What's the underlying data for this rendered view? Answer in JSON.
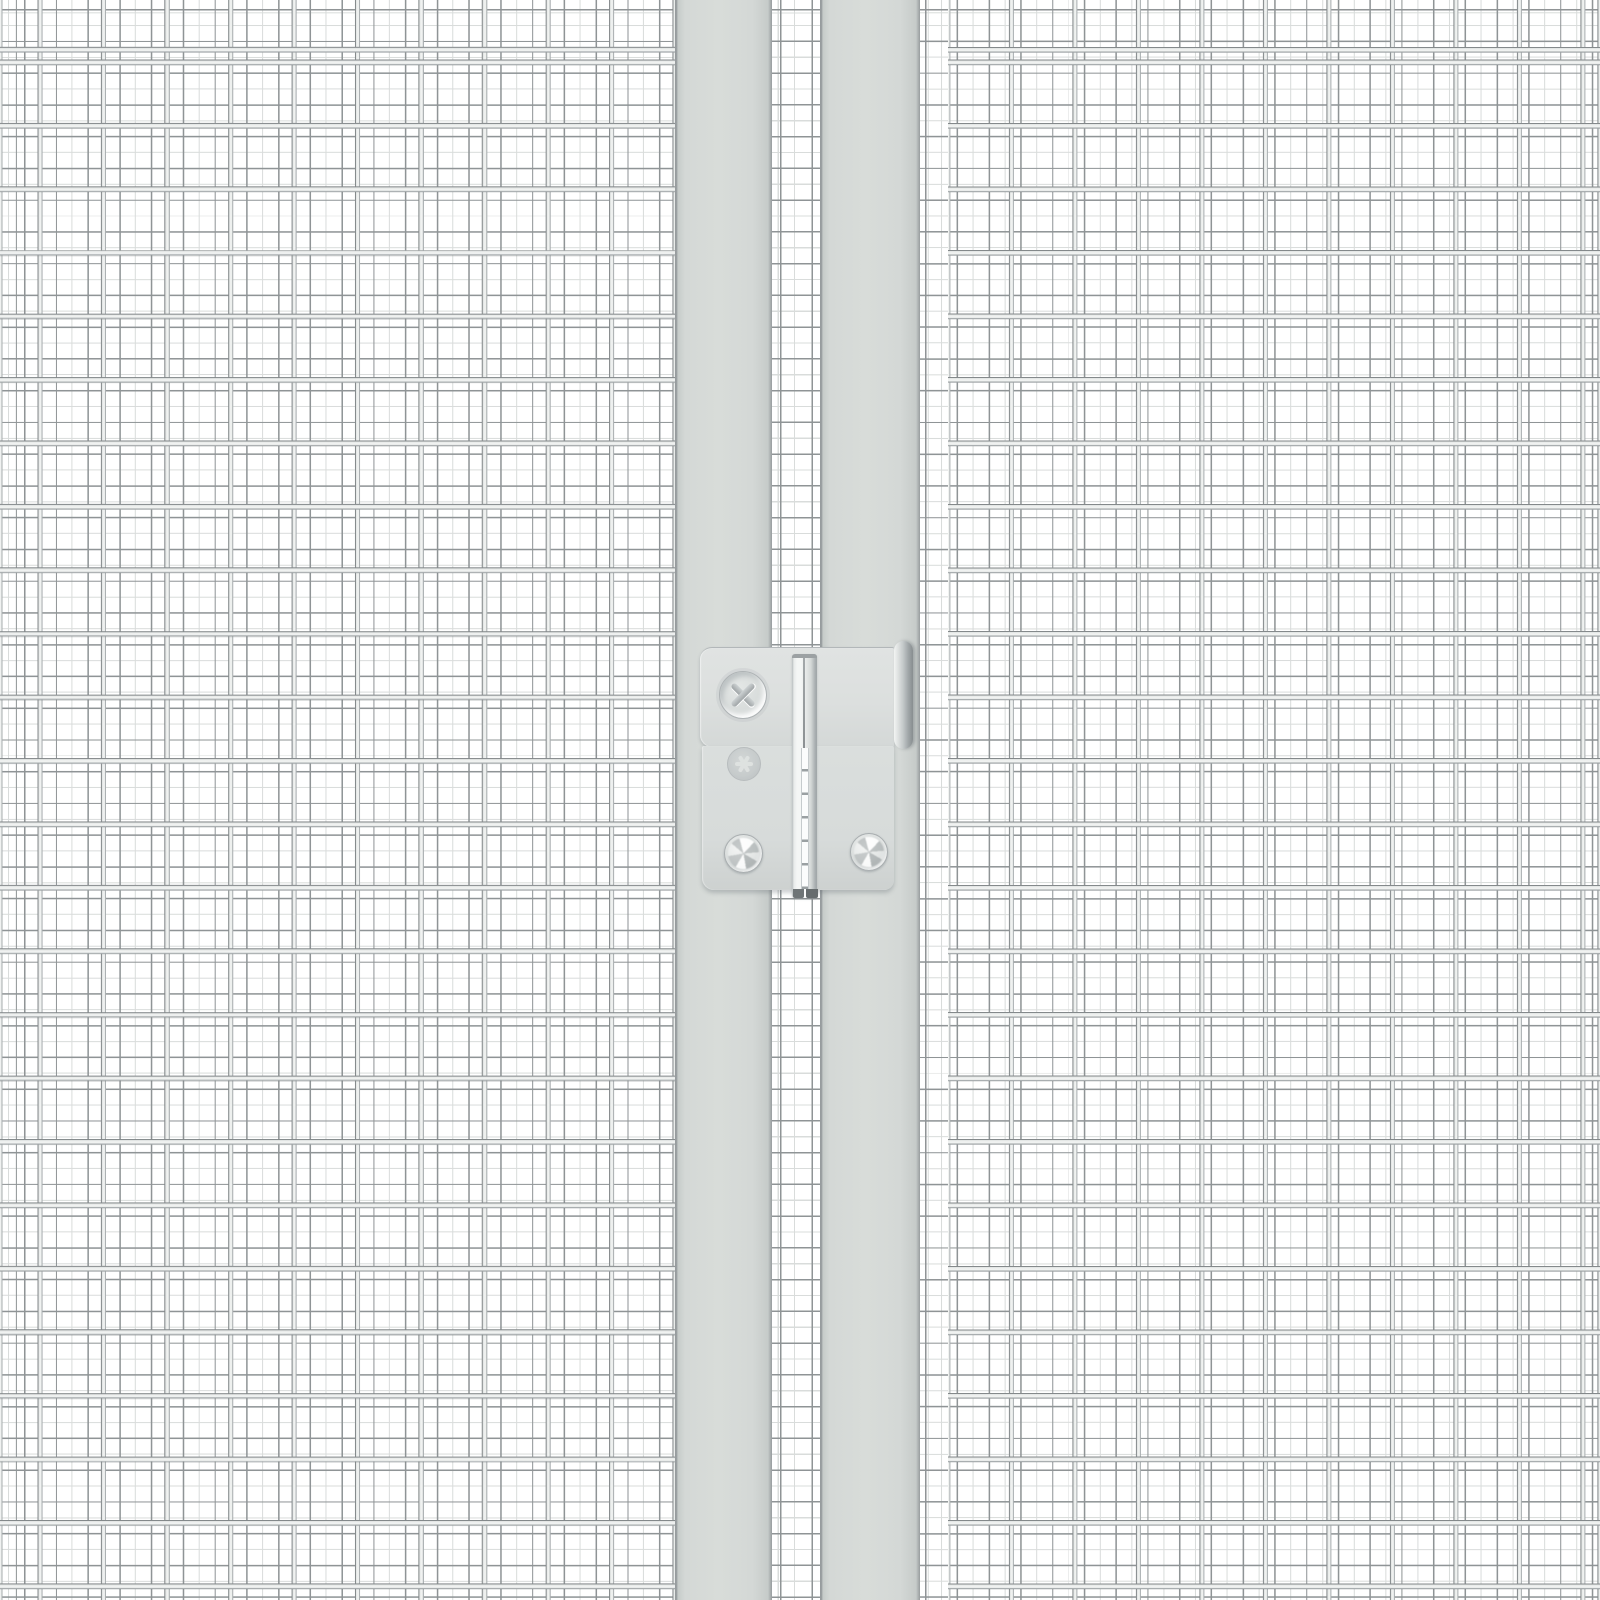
{
  "scene": {
    "description": "Close-up product render of a light-grey industrial wire-mesh partition: two welded-mesh panels, two vertical frame posts with a narrow mesh gap between them, and a surface-mounted hinge with screws",
    "width_px": 1600,
    "height_px": 1600
  },
  "colors": {
    "bg": "#ffffff",
    "wire-dark": "#84898b",
    "wire-mid": "#dfe2e1",
    "wire-bright": "#f0f2f1",
    "wire-shadow": "#a9aeb0",
    "rear-wire": "#8f9496",
    "rear-faint": "#d9dcdb",
    "post-fill": "#d4d8d6",
    "post-fill-bright": "#d8dcd9",
    "post-edge-dark": "#979c9e",
    "post-edge-light": "#c6cbc9",
    "plate-fill": "#dcdfde",
    "plate-fill-low": "#d7dbda",
    "plate-edge": "#b2b7b9",
    "pin-bright": "#f4f6f5",
    "pin-body": "#e6e9e8",
    "pin-dark": "#aab0b2",
    "pin-seam": "#8b9092",
    "pin-foot": "#6f7577",
    "cyl-light": "#f2f4f3",
    "cyl-mid": "#c4c9ca",
    "cyl-dark": "#878d8f",
    "screw-face": "#d8dcdb",
    "screw-hi": "#eef0ef",
    "screw-lo": "#b6bbbd",
    "screw-edge": "#a9aeb0",
    "screw-slot": "#9fa4a6"
  },
  "geometry_px": {
    "front-pitch": 63.5,
    "rear-pitch": 31.75,
    "left-post-x": 675,
    "left-post-w": 97,
    "right-post-x": 820,
    "right-post-w": 100,
    "gap-x": 772,
    "gap-w": 48,
    "right-rear-x": 920,
    "right-front-x": 948
  },
  "components": {
    "left_mesh_panel": "left welded mesh panel",
    "right_mesh_panel": "right welded mesh panel",
    "rear_mesh": "far-side fine mesh visible through panels",
    "gap_mesh_strip": "mesh strip visible between the two posts",
    "left_post": "left frame post",
    "right_post": "right frame post",
    "hinge_upper_plate": "hinge upper mounting plate",
    "hinge_lower_plate": "hinge lower mounting plate",
    "hinge_pin": "vertical hinge pin strip",
    "hinge_barrel": "rounded hinge barrel on right post",
    "phillips_screw": "large phillips-head screw",
    "recessed_screw": "recessed screw seen through plate hole",
    "screw_bottom_left": "lower-left hinge screw",
    "screw_bottom_right": "lower-right hinge screw"
  }
}
